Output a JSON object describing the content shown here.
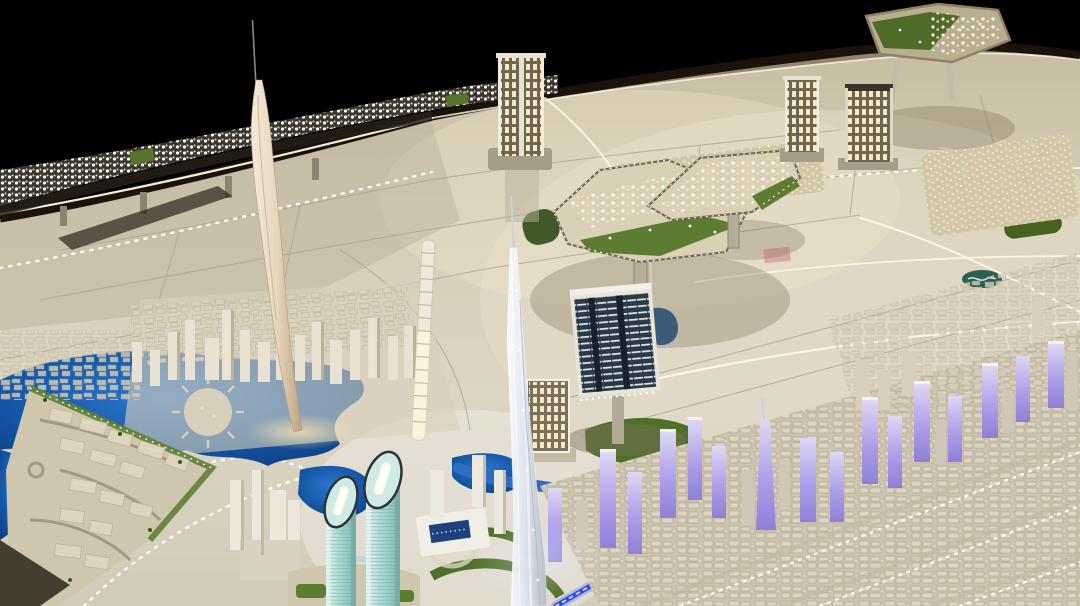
{
  "scene": {
    "kind": "photograph",
    "subject": "illuminated architectural scale model of a city displayed on a dark exhibition table",
    "landmarks": {
      "needle_spire": "slender cream spindle tower with needle tip (back left)",
      "crystal_tower": "tall translucent faceted skyscraper model (center foreground)",
      "twin_teal_towers": "two cylindrical glass towers with dark sliced elliptical tops (foreground left-center)",
      "segmented_column_tower": "white stacked-segment tower under construction",
      "floating_platforms": "elevated development plates on stalks with lit villas and greenery",
      "lit_towers": "illuminated high-rise models with warm window grids",
      "dark_glass_slab": "floating dark blue office slab with lit floor lines",
      "strip_development": "elevated band of densely lit miniature buildings along the back rim",
      "lagoon": "deep blue lagoon with circular pier island (lower left)",
      "canal": "winding bright blue canal (lower center)",
      "transit_line": "glowing blue LED transit strip crossing the right foreground",
      "purple_district": "white towers lit lavender along the transit line",
      "triangular_island": "raised triangular district with beige blocks and green fringe (bottom left)",
      "low_rise_grid": "dense beige low-rise blocks with white LED dotted streets (right foreground)"
    }
  },
  "palette": {
    "background": "#000000",
    "table_rim": "#1b130b",
    "base_light": "#dcd5c3",
    "base_dark": "#c7bda2",
    "etched_road": "#aaa18a",
    "led_white": "#fffdf2",
    "road_white": "#fff8e6",
    "lagoon": "#1558a8",
    "canal": "#2f6cc2",
    "led_blue": "#2b46e8",
    "led_blue_glow": "#6a7cf6",
    "green_dark": "#4e7028",
    "green_mid": "#5d7c31",
    "purple_light": "#ab9fe8",
    "teal_glass": "#a8d8d2",
    "teal_rim": "#2c3337",
    "crystal": "#dfe5ec",
    "spire_cream": "#e7d7bd",
    "warm_window": "#ffefc8",
    "dark_glass": "#2c3a48",
    "shadow": "#7d7258",
    "pink_block": "#d8a9a2"
  }
}
